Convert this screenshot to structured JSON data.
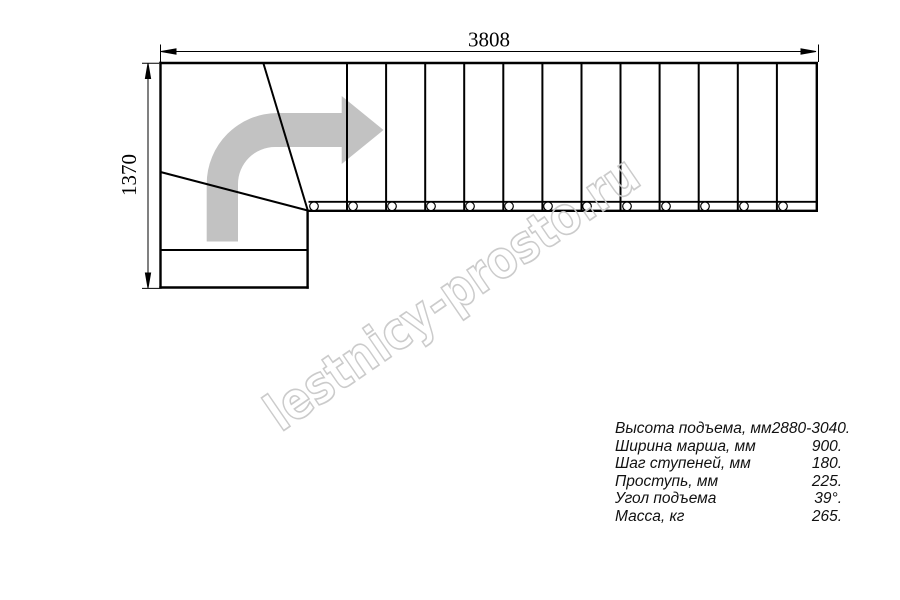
{
  "dimensions": {
    "width_mm": "3808",
    "depth_mm": "1370"
  },
  "watermark": {
    "text": "lestnicy-prosto.ru"
  },
  "specs": {
    "rows": [
      {
        "label": "Высота подъема, мм",
        "value": "2880-3040."
      },
      {
        "label": "Ширина марша, мм",
        "value": "900."
      },
      {
        "label": "Шаг ступеней, мм",
        "value": "180."
      },
      {
        "label": "Проступь, мм",
        "value": "225."
      },
      {
        "label": "Угол подъема",
        "value": "39°."
      },
      {
        "label": "Масса, кг",
        "value": "265."
      }
    ]
  },
  "colors": {
    "line": "#000000",
    "direction_arrow": "#c2c2c2",
    "watermark": "#c9c9c9"
  }
}
